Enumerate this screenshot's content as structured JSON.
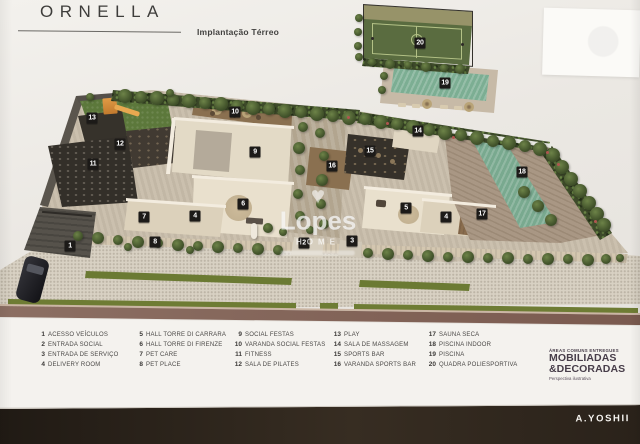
{
  "header": {
    "title": "ORNELLA",
    "subtitle": "Implantação Térreo"
  },
  "watermark": {
    "brand": "Lopes",
    "tagline": "HOME"
  },
  "legend": {
    "columns": [
      [
        {
          "n": "1",
          "label": "ACESSO VEÍCULOS"
        },
        {
          "n": "2",
          "label": "ENTRADA SOCIAL"
        },
        {
          "n": "3",
          "label": "ENTRADA DE SERVIÇO"
        },
        {
          "n": "4",
          "label": "DELIVERY ROOM"
        }
      ],
      [
        {
          "n": "5",
          "label": "HALL TORRE DI CARRARA"
        },
        {
          "n": "6",
          "label": "HALL TORRE DI FIRENZE"
        },
        {
          "n": "7",
          "label": "PET CARE"
        },
        {
          "n": "8",
          "label": "PET PLACE"
        }
      ],
      [
        {
          "n": "9",
          "label": "SOCIAL FESTAS"
        },
        {
          "n": "10",
          "label": "VARANDA SOCIAL FESTAS"
        },
        {
          "n": "11",
          "label": "FITNESS"
        },
        {
          "n": "12",
          "label": "SALA DE PILATES"
        }
      ],
      [
        {
          "n": "13",
          "label": "PLAY"
        },
        {
          "n": "14",
          "label": "SALA DE MASSAGEM"
        },
        {
          "n": "15",
          "label": "SPORTS BAR"
        },
        {
          "n": "16",
          "label": "VARANDA SPORTS BAR"
        }
      ],
      [
        {
          "n": "17",
          "label": "SAUNA SECA"
        },
        {
          "n": "18",
          "label": "PISCINA INDOOR"
        },
        {
          "n": "19",
          "label": "PISCINA"
        },
        {
          "n": "20",
          "label": "QUADRA POLIESPORTIVA"
        }
      ]
    ]
  },
  "badge": {
    "line1": "ÁREAS COMUNS ENTREGUES",
    "line2": "MOBILIADAS",
    "line3": "&DECORADAS",
    "line4": "Perspectiva ilustrativa"
  },
  "footer": {
    "brand": "A.YOSHII"
  },
  "plan_markers": [
    {
      "n": "1",
      "x": 70,
      "y": 246
    },
    {
      "n": "2",
      "x": 304,
      "y": 243
    },
    {
      "n": "3",
      "x": 352,
      "y": 241
    },
    {
      "n": "4",
      "x": 195,
      "y": 216
    },
    {
      "n": "4",
      "x": 446,
      "y": 217
    },
    {
      "n": "5",
      "x": 406,
      "y": 208
    },
    {
      "n": "6",
      "x": 243,
      "y": 204
    },
    {
      "n": "7",
      "x": 144,
      "y": 217
    },
    {
      "n": "8",
      "x": 155,
      "y": 242
    },
    {
      "n": "9",
      "x": 255,
      "y": 152
    },
    {
      "n": "10",
      "x": 235,
      "y": 112
    },
    {
      "n": "11",
      "x": 93,
      "y": 164
    },
    {
      "n": "12",
      "x": 120,
      "y": 144
    },
    {
      "n": "13",
      "x": 92,
      "y": 118
    },
    {
      "n": "14",
      "x": 418,
      "y": 131
    },
    {
      "n": "15",
      "x": 370,
      "y": 151
    },
    {
      "n": "16",
      "x": 332,
      "y": 166
    },
    {
      "n": "17",
      "x": 482,
      "y": 214
    },
    {
      "n": "18",
      "x": 522,
      "y": 172
    },
    {
      "n": "19",
      "x": 445,
      "y": 83
    },
    {
      "n": "20",
      "x": 420,
      "y": 43
    }
  ],
  "colors": {
    "hedge_green": "#3e4b2a",
    "pool_water": "#7cae93",
    "marker_bg": "#1c1a18",
    "footer_bg": "#26201a",
    "badge_text": "#473d49"
  }
}
